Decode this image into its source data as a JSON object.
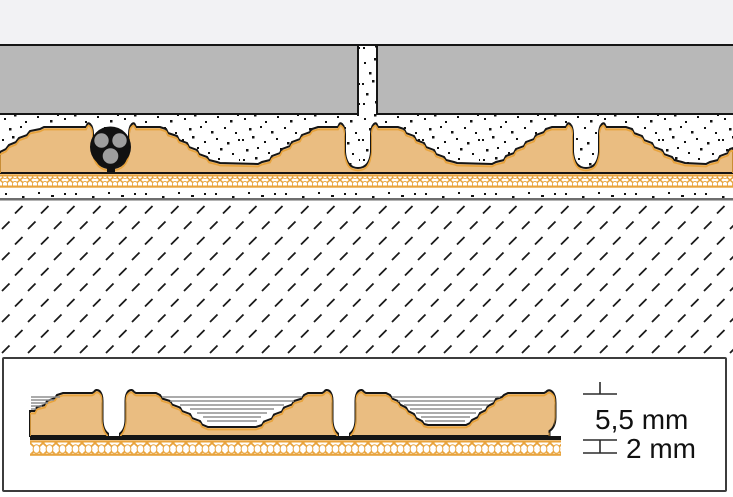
{
  "annotations": {
    "membrane_height_label": "5,5 mm",
    "base_thickness_label": "2 mm"
  },
  "colors": {
    "background_top": "#F2F2F4",
    "tile_gray": "#B8B8B8",
    "membrane_tan": "#EABD81",
    "accent_orange": "#E8A33C",
    "outline_black": "#151515",
    "contour_gray": "#8F8F8F",
    "conductor_gray": "#9E9E9E",
    "screed_line_gray": "#6E6E6E"
  }
}
